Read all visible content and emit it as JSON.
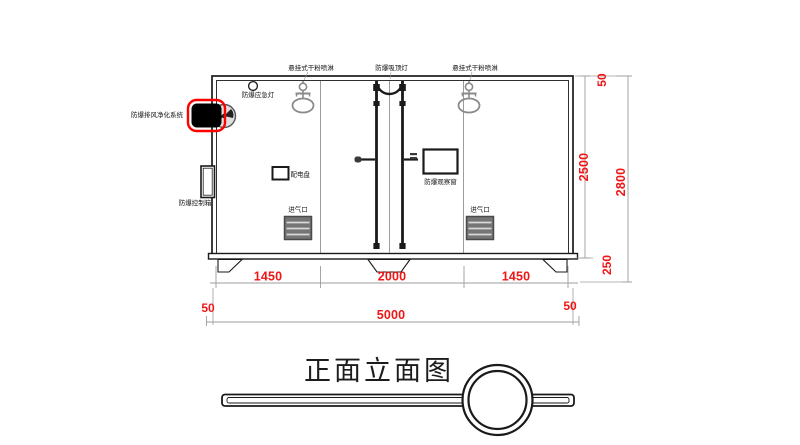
{
  "page": {
    "background": "#ffffff"
  },
  "title_block": {
    "title": "正面立面图"
  },
  "equipment_labels": {
    "sprinkler_left": "悬挂式干粉喷淋",
    "ceiling_light": "防爆吸顶灯",
    "sprinkler_right": "悬挂式干粉喷淋",
    "emergency_light": "防爆应急灯",
    "exhaust_purification": "防爆排风净化系统",
    "control_box": "防爆控制箱",
    "power_panel": "配电盘",
    "observation_window": "防爆观察窗",
    "air_inlet_left": "进气口",
    "air_inlet_right": "进气口"
  },
  "dimensions": {
    "bay_widths": [
      "1450",
      "2000",
      "1450"
    ],
    "wall_left": "50",
    "overall_width": "5000",
    "wall_right": "50",
    "roof_offset": "50",
    "body_height": "2500",
    "overall_height": "2800",
    "base_height": "250"
  },
  "colors": {
    "dimension_text": "#f01616",
    "highlight_red": "#ff0000",
    "line_black": "#1a1a1a",
    "line_gray": "#9c9c9c"
  }
}
